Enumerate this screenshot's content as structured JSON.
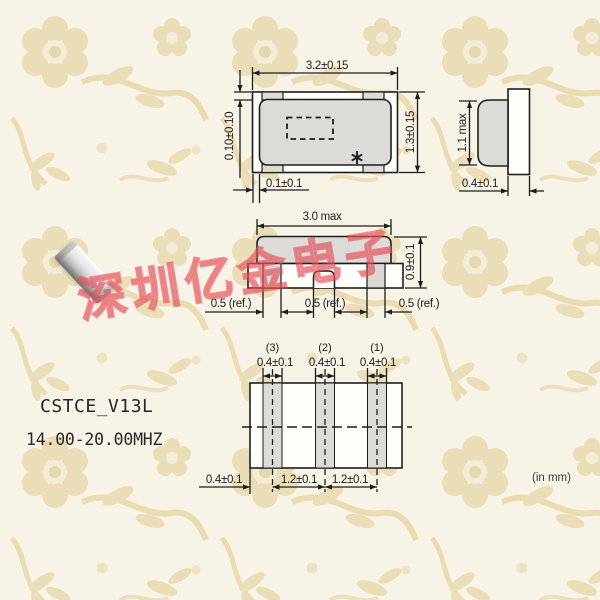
{
  "watermark": {
    "text": "深圳亿金电子",
    "color": "#e13e4a"
  },
  "product": {
    "model": "CSTCE_V13L",
    "frequency_range": "14.00-20.00MHZ"
  },
  "note": {
    "units": "(in mm)"
  },
  "colors": {
    "line": "#1d1d1d",
    "body_gray": "#dcdbd7",
    "white_fill": "#fdfdfa",
    "wallpaper_base": "#f7f3e6",
    "wallpaper_motif": "#e8d8ac"
  },
  "top_view": {
    "width": "3.2±0.15",
    "height": "1.3±0.15",
    "lid_inset": "0.10±0.10",
    "side_inset": "0.1±0.1",
    "mark_icon": "asterisk"
  },
  "side_view": {
    "height": "1.1 max",
    "terminal": "0.4±0.1"
  },
  "front_view": {
    "width": "3.0 max",
    "height": "0.9±0.1",
    "ref_left": "0.5 (ref.)",
    "ref_center": "0.5 (ref.)",
    "ref_right": "0.5 (ref.)"
  },
  "land_pattern": {
    "pad_labels": [
      "(3)",
      "(2)",
      "(1)"
    ],
    "pad_widths": [
      "0.4±0.1",
      "0.4±0.1",
      "0.4±0.1"
    ],
    "edge_offset": "0.4±0.1",
    "pitches": [
      "1.2±0.1",
      "1.2±0.1"
    ]
  }
}
